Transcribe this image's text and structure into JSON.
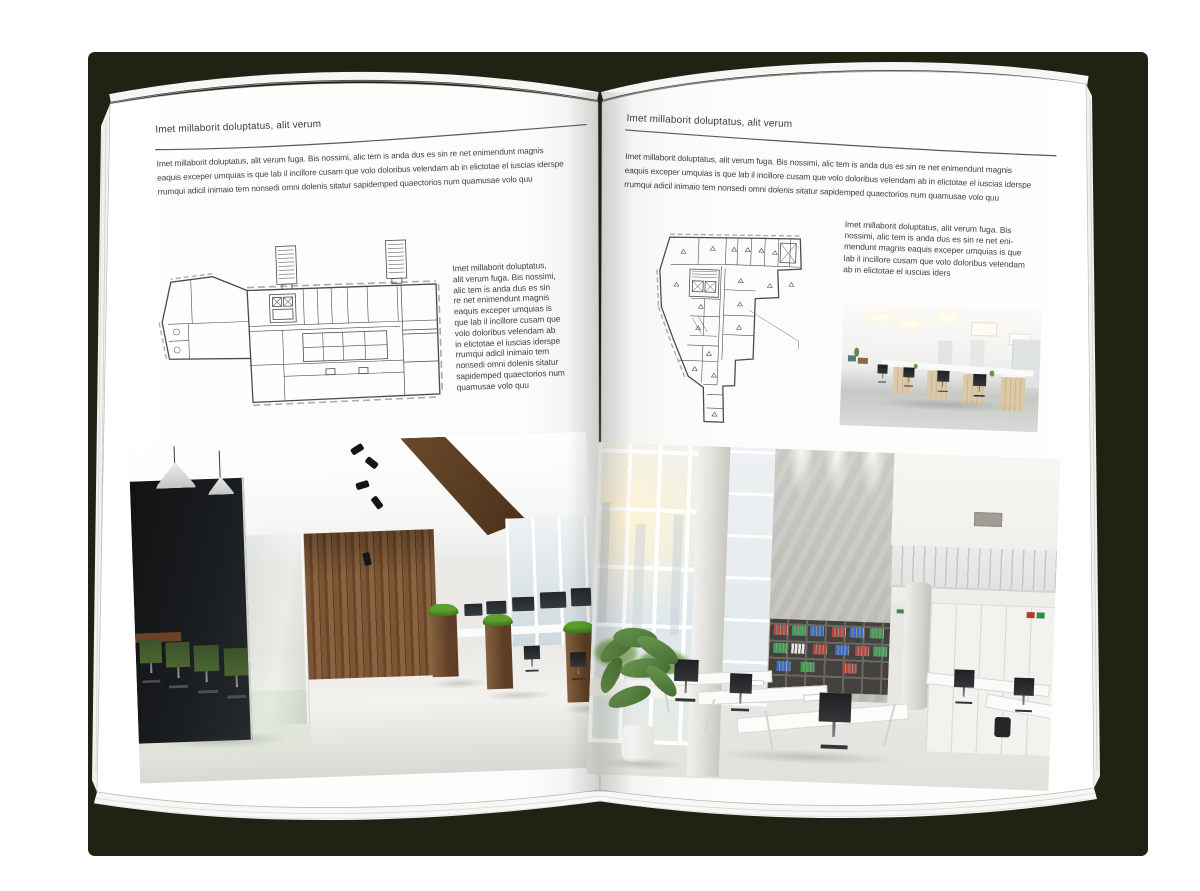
{
  "canvas": {
    "background": "#ffffff"
  },
  "book": {
    "cover_color": "#1f2314",
    "palette": {
      "page_white": "#fdfdfd",
      "text": "#3d3e40",
      "wood": "#7a5436",
      "dark_glass": "#16191b",
      "chair_green": "#425a2e",
      "plant_green": "#5d8a43",
      "binder_red": "#b5473b",
      "binder_green": "#3c9e4e",
      "binder_blue": "#3a6cc8",
      "concrete": "#c6c4bf",
      "floor_light": "#e8e7e3"
    },
    "pages": {
      "left": {
        "header": "Imet millaborit doluptatus, alit verum",
        "intro_lines": [
          "Imet millaborit doluptatus, alit verum fuga. Bis nossimi, alic tem is anda dus es sin re net enimendunt magnis",
          "eaquis exceper umquias is que lab il incillore cusam que volo doloribus velendam ab in elictotae el iuscias iderspe",
          "rrumqui adicil inimaio tem nonsedi omni dolenis sitatur sapidemped quaectorios num quamusae volo quu"
        ],
        "side_text_lines": [
          "Imet millaborit doluptatus,",
          "alit verum fuga. Bis nossimi,",
          "alic tem is anda dus es sin",
          "re net enimendunt magnis",
          "eaquis exceper umquias is",
          "que lab il incillore cusam que",
          "volo doloribus velendam ab",
          "in elictotae el iuscias iderspe",
          "rrumqui adicil inimaio tem",
          "nonsedi omni dolenis sitatur",
          "sapidemped quaectorios num",
          "quamusae volo quu"
        ],
        "floor_plan": "floor-plan-left",
        "photo": "office-photo-wood-glass"
      },
      "right": {
        "header": "Imet millaborit doluptatus, alit verum",
        "intro_lines": [
          "Imet millaborit doluptatus, alit verum fuga. Bis nossimi, alic tem is anda dus es sin re net enimendunt magnis",
          "eaquis exceper umquias is que lab il incillore cusam que volo doloribus velendam ab in elictotae el iuscias iderspe",
          "rrumqui adicil inimaio tem nonsedi omni dolenis sitatur sapidemped quaectorios num quamusae volo quu"
        ],
        "side_text_lines": [
          "Imet millaborit doluptatus, alit verum fuga. Bis",
          "nossimi, alic tem is anda dus es sin re net eni-",
          "mendunt magnis eaquis exceper umquias is que",
          "lab il incillore cusam que volo doloribus velendam",
          "ab in elictotae el iuscias iders"
        ],
        "floor_plan": "floor-plan-right",
        "photo_small": "office-photo-workstations",
        "photo_large": "office-photo-atrium"
      }
    }
  }
}
